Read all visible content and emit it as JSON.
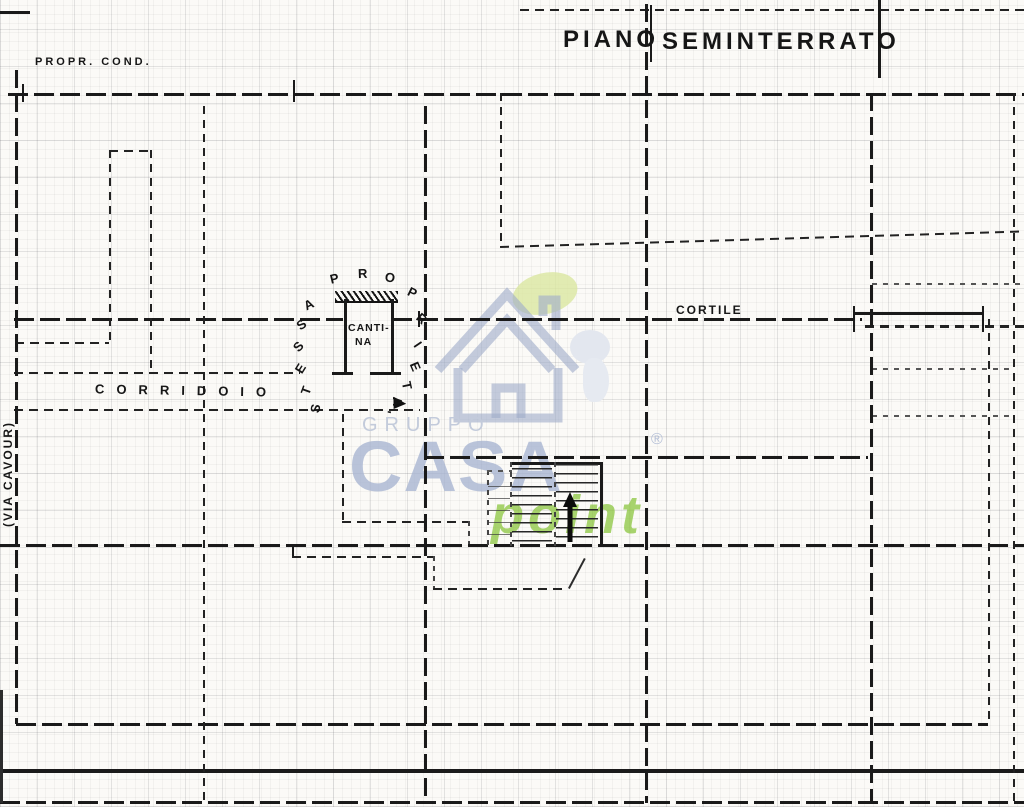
{
  "document": {
    "title_left": "PIANO",
    "title_right": "SEMINTERRATO"
  },
  "labels": {
    "property_note": "PROPR. COND.",
    "corridor": "CORRIDOIO",
    "courtyard": "CORTILE",
    "cellar_line1": "CANTI-",
    "cellar_line2": "NA",
    "street": "(VIA CAVOUR)",
    "same_property_arc": "STESSA PROPRIETA'"
  },
  "arc_letters": [
    {
      "c": "S",
      "x": 311,
      "y": 401,
      "r": -78
    },
    {
      "c": "T",
      "x": 302,
      "y": 383,
      "r": -70
    },
    {
      "c": "E",
      "x": 296,
      "y": 361,
      "r": -58
    },
    {
      "c": "S",
      "x": 294,
      "y": 339,
      "r": -47
    },
    {
      "c": "S",
      "x": 297,
      "y": 317,
      "r": -36
    },
    {
      "c": "A",
      "x": 304,
      "y": 297,
      "r": -26
    },
    {
      "c": "P",
      "x": 330,
      "y": 271,
      "r": -13
    },
    {
      "c": "R",
      "x": 358,
      "y": 266,
      "r": -2
    },
    {
      "c": "O",
      "x": 385,
      "y": 270,
      "r": 10
    },
    {
      "c": "P",
      "x": 408,
      "y": 285,
      "r": 26
    },
    {
      "c": "R",
      "x": 417,
      "y": 311,
      "r": 42
    },
    {
      "c": "I",
      "x": 416,
      "y": 337,
      "r": 56
    },
    {
      "c": "E",
      "x": 411,
      "y": 359,
      "r": 67
    },
    {
      "c": "T",
      "x": 403,
      "y": 378,
      "r": 78
    },
    {
      "c": "A",
      "x": 393,
      "y": 394,
      "r": 90
    },
    {
      "c": "'",
      "x": 385,
      "y": 404,
      "r": 100
    }
  ],
  "watermark": {
    "gruppo": "GRUPPO",
    "casa": "CASA",
    "registered": "®",
    "point": "point",
    "colors": {
      "blue": "#a9b6d2",
      "green": "#8cc63f",
      "leaf": "#dbe7a0"
    }
  }
}
